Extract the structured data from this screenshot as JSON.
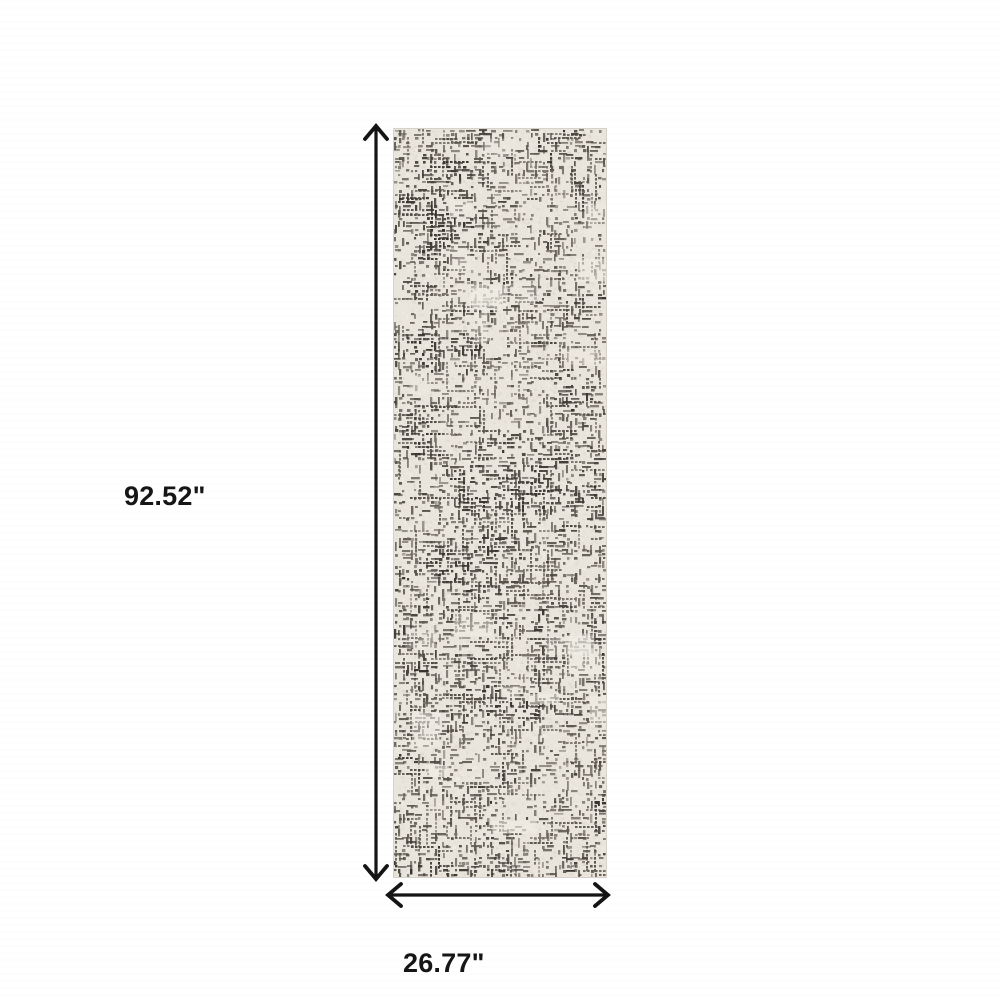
{
  "product": {
    "name": "runner-rug",
    "description": "Ivory and charcoal abstract distressed grid pattern runner rug shown flat, top view",
    "pattern": {
      "base_color": "#e9e5dc",
      "light_patch_color": "#f1eee6",
      "mottle_color": "#dcd7cc",
      "mark_colors": [
        "#37332e",
        "#49443e",
        "#5d5850",
        "#7a746b"
      ],
      "edge_color": "#d6d2c9"
    }
  },
  "dimensions": {
    "height_label": "92.52\"",
    "width_label": "26.77\"",
    "line_color": "#141414"
  }
}
